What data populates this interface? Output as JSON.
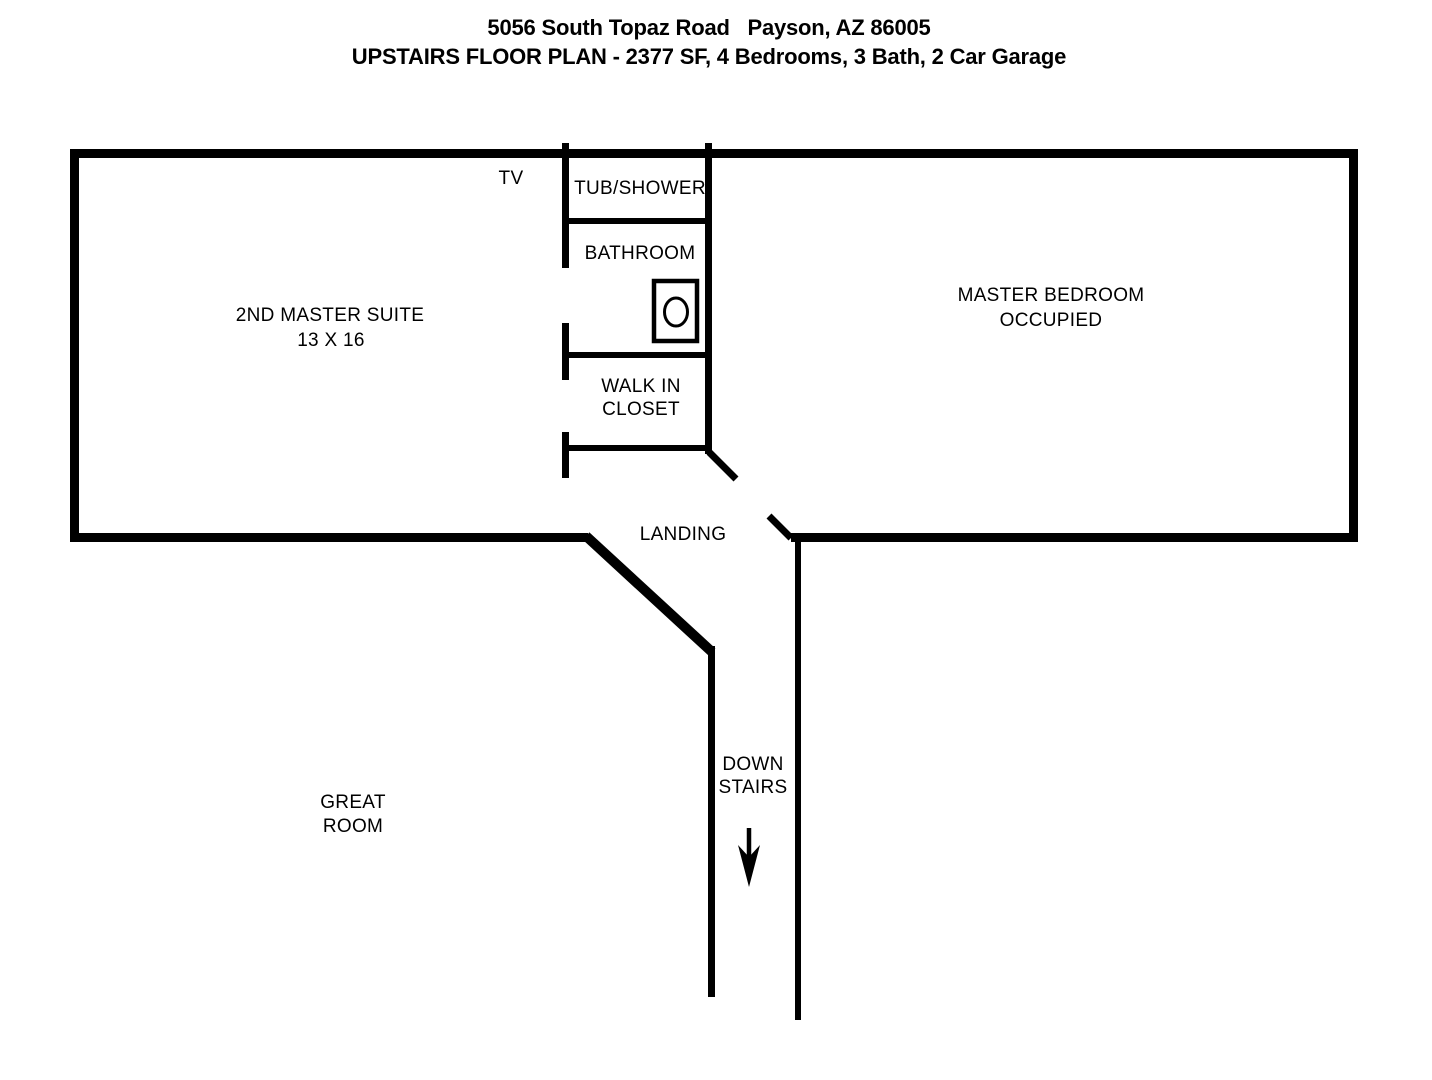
{
  "title": {
    "address": "5056 South Topaz Road   Payson, AZ 86005",
    "subtitle": "UPSTAIRS FLOOR PLAN - 2377 SF, 4 Bedrooms, 3 Bath, 2 Car Garage"
  },
  "rooms": {
    "second_master_suite": {
      "name": "2ND MASTER SUITE",
      "dimensions": "13 X 16"
    },
    "master_bedroom": {
      "name": "MASTER BEDROOM",
      "status": "OCCUPIED"
    },
    "tub_shower": {
      "name": "TUB/SHOWER"
    },
    "bathroom": {
      "name": "BATHROOM"
    },
    "walk_in_closet": {
      "name_line1": "WALK IN",
      "name_line2": "CLOSET"
    },
    "landing": {
      "name": "LANDING"
    },
    "stairs": {
      "direction_line1": "DOWN",
      "direction_line2": "STAIRS"
    },
    "great_room": {
      "name_line1": "GREAT",
      "name_line2": "ROOM"
    }
  },
  "annotations": {
    "tv": "TV"
  },
  "colors": {
    "walls": "#000000",
    "background": "#ffffff",
    "text": "#000000"
  }
}
